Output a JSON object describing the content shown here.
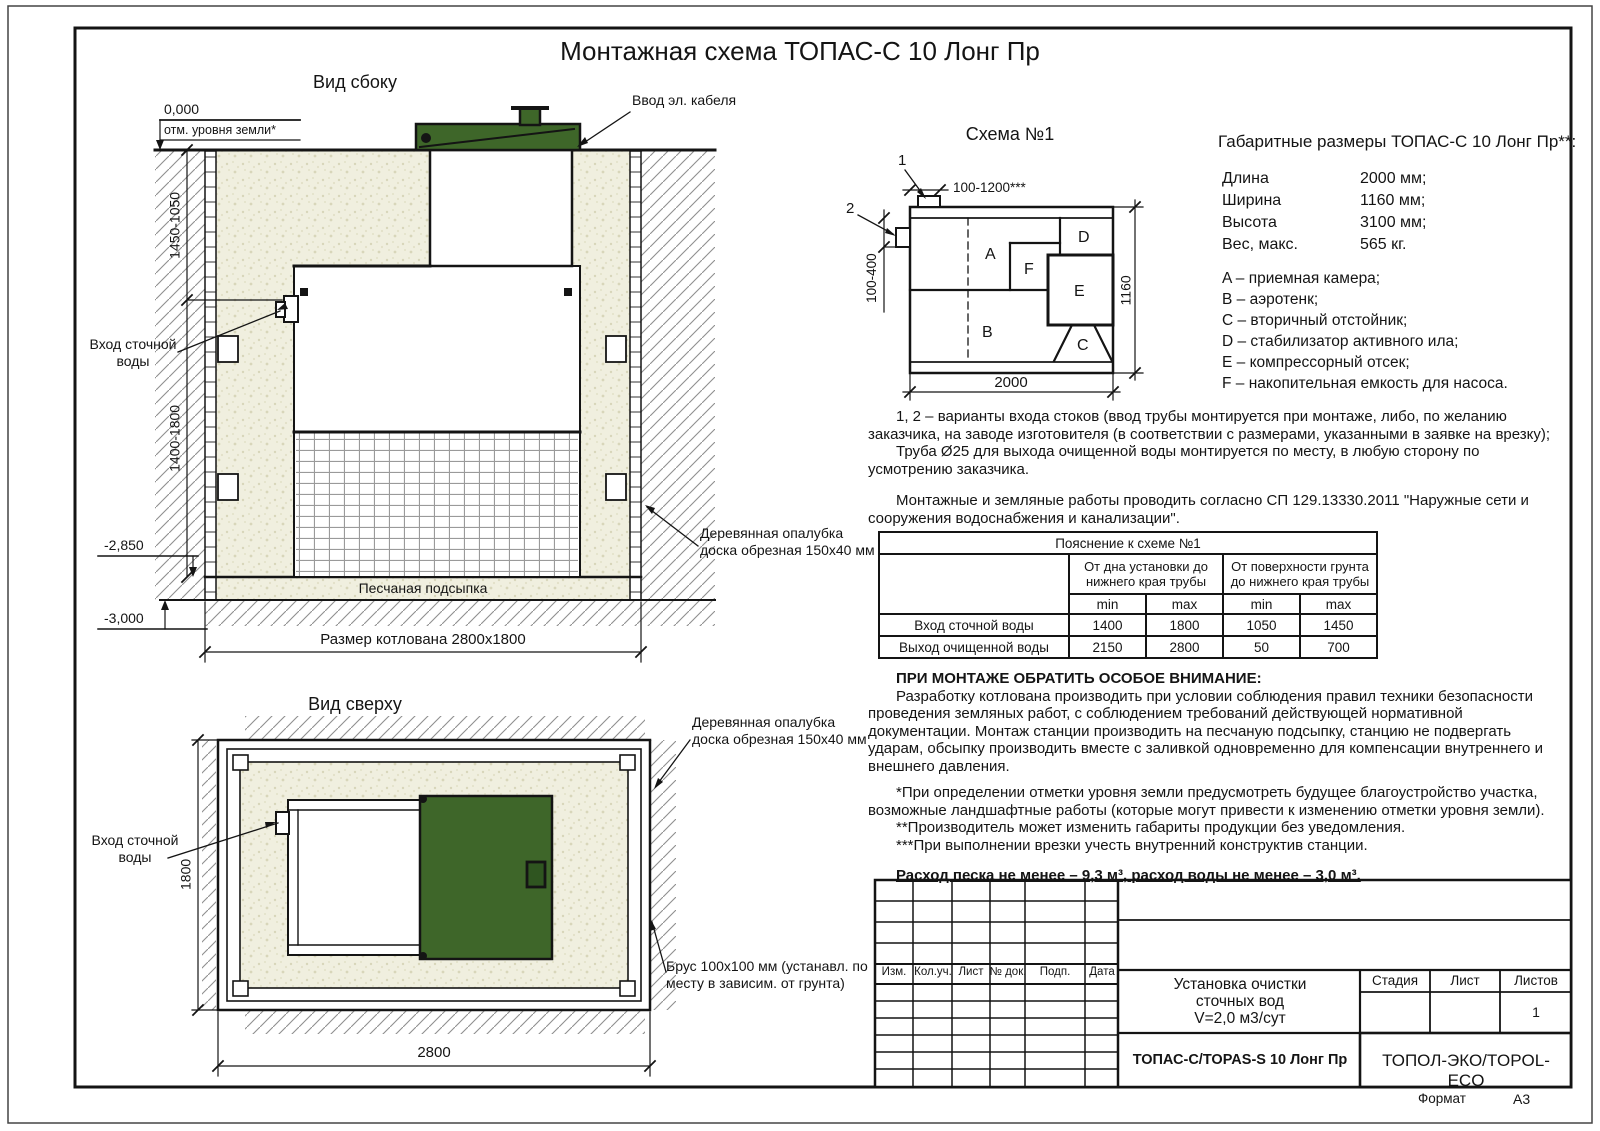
{
  "page": {
    "title": "Монтажная схема ТОПАС-С 10 Лонг Пр",
    "format_label": "Формат",
    "format_value": "А3"
  },
  "colors": {
    "lid_green": "#3e6629",
    "sand": "#f0efdf",
    "line": "#141414"
  },
  "side_view": {
    "title": "Вид сбоку",
    "zero_mark": "0,000",
    "ground_label": "отм. уровня земли*",
    "cable_label": "Ввод эл. кабеля",
    "inlet_label": "Вход сточной\nводы",
    "dim_upper": "1450-1050",
    "dim_lower": "1400-1800",
    "level_2850": "-2,850",
    "level_3000": "-3,000",
    "bedding_label": "Песчаная подсыпка",
    "pit_dim": "Размер котлована 2800х1800",
    "formwork_label": "Деревянная опалубка\nдоска обрезная 150х40 мм"
  },
  "top_view": {
    "title": "Вид сверху",
    "inlet_label": "Вход сточной\nводы",
    "dim_h": "1800",
    "dim_w": "2800",
    "formwork_label": "Деревянная опалубка\nдоска обрезная 150х40 мм",
    "beam_label": "Брус 100х100 мм (устанавл. по\nместу в зависим. от грунта)"
  },
  "schema1": {
    "title": "Схема №1",
    "labels": {
      "a": "A",
      "b": "B",
      "c": "C",
      "d": "D",
      "e": "E",
      "f": "F"
    },
    "marker1": "1",
    "marker2": "2",
    "dim_top": "100-1200***",
    "dim_left": "100-400",
    "dim_width": "2000",
    "dim_height": "1160"
  },
  "specs": {
    "heading": "Габаритные размеры ТОПАС-С 10 Лонг Пр**:",
    "rows": [
      {
        "label": "Длина",
        "value": "2000 мм;"
      },
      {
        "label": "Ширина",
        "value": "1160 мм;"
      },
      {
        "label": "Высота",
        "value": "3100 мм;"
      },
      {
        "label": "Вес, макс.",
        "value": "565 кг."
      }
    ],
    "legend": [
      "A – приемная камера;",
      "B – аэротенк;",
      "C – вторичный отстойник;",
      "D – стабилизатор активного ила;",
      "E – компрессорный отсек;",
      "F – накопительная емкость для насоса."
    ]
  },
  "notes": {
    "p1": "1, 2 – варианты входа стоков (ввод трубы монтируется при монтаже, либо, по желанию заказчика, на заводе изготовителя (в соответствии с размерами, указанными в заявке на врезку);",
    "p2": "Труба Ø25 для выхода очищенной воды монтируется по месту, в любую сторону по усмотрению заказчика.",
    "p3": "Монтажные и земляные работы проводить согласно СП 129.13330.2011 \"Наружные сети и сооружения водоснабжения и канализации\"."
  },
  "explain_table": {
    "title": "Пояснение к схеме №1",
    "col_group1": "От дна установки до нижнего края трубы",
    "col_group2": "От поверхности грунта до нижнего края трубы",
    "min_label": "min",
    "max_label": "max",
    "rows": [
      {
        "label": "Вход сточной воды",
        "v1": "1400",
        "v2": "1800",
        "v3": "1050",
        "v4": "1450"
      },
      {
        "label": "Выход очищенной воды",
        "v1": "2150",
        "v2": "2800",
        "v3": "50",
        "v4": "700"
      }
    ]
  },
  "attention": {
    "heading": "ПРИ МОНТАЖЕ ОБРАТИТЬ ОСОБОЕ ВНИМАНИЕ:",
    "body": "Разработку котлована производить при условии соблюдения правил техники безопасности проведения земляных работ, с соблюдением требований действующей нормативной документации. Монтаж станции производить на песчаную подсыпку, станцию не подвергать ударам, обсыпку производить вместе с заливкой одновременно для компенсации внутреннего и внешнего давления.",
    "fn1": "*При определении отметки уровня земли предусмотреть будущее благоустройство участка, возможные ландшафтные работы (которые могут привести к изменению отметки уровня земли).",
    "fn2": "**Производитель может изменить габариты продукции без уведомления.",
    "fn3": "***При выполнении врезки учесть внутренний конструктив станции.",
    "consumption": "Расход песка не менее – 9,3 м³, расход воды не менее – 3,0 м³."
  },
  "title_block": {
    "rev_headers": [
      "Изм.",
      "Кол.уч.",
      "Лист",
      "№ док.",
      "Подп.",
      "Дата"
    ],
    "project": "Установка очистки\nсточных вод\nV=2,0 м3/сут",
    "model": "ТОПАС-С/TOPAS-S 10 Лонг Пр",
    "company": "ТОПОЛ-ЭКО/TOPOL-ECO",
    "stage_label": "Стадия",
    "sheet_label": "Лист",
    "sheets_label": "Листов",
    "sheets_value": "1"
  }
}
